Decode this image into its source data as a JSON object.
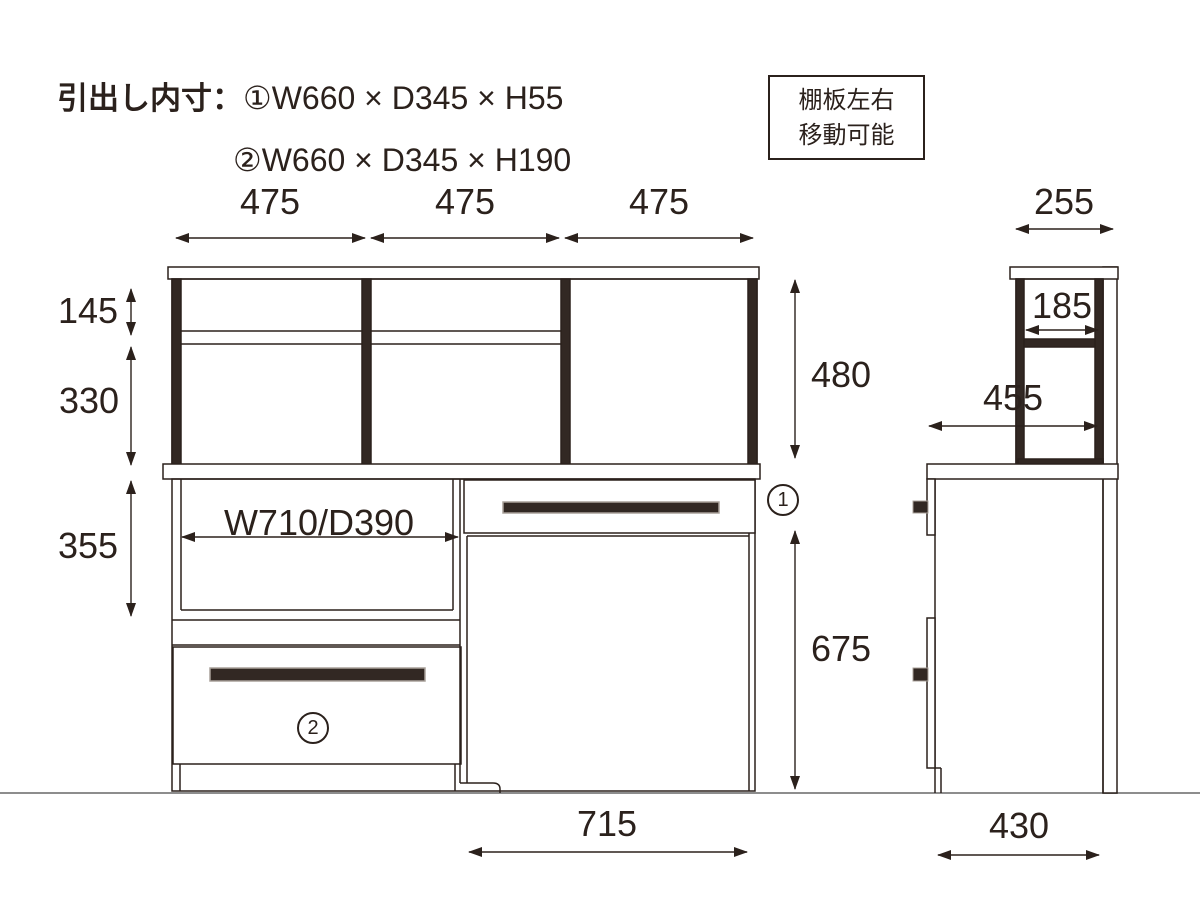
{
  "drawing_title": {
    "label": "引出し内寸：",
    "item1": "①W660 × D345 × H55",
    "item2": "②W660 × D345 × H190"
  },
  "note_box": {
    "line1": "棚板左右",
    "line2": "移動可能"
  },
  "front_view": {
    "top_width_left": "475",
    "top_width_center": "475",
    "top_width_right": "475",
    "hutch_upper_height": "145",
    "hutch_lower_height": "330",
    "open_space_height": "355",
    "hutch_total_height": "480",
    "knee_space_height": "675",
    "open_space_label": "W710/D390",
    "knee_space_width": "715",
    "drawer1_mark": "1",
    "drawer2_mark": "2"
  },
  "side_view": {
    "hutch_top_depth": "255",
    "hutch_inner_depth": "185",
    "counter_depth": "455",
    "base_depth": "430"
  },
  "colors": {
    "line": "#2b211c",
    "dark_fill": "#322823",
    "floor_line": "#8d8d8d",
    "background": "#ffffff"
  }
}
